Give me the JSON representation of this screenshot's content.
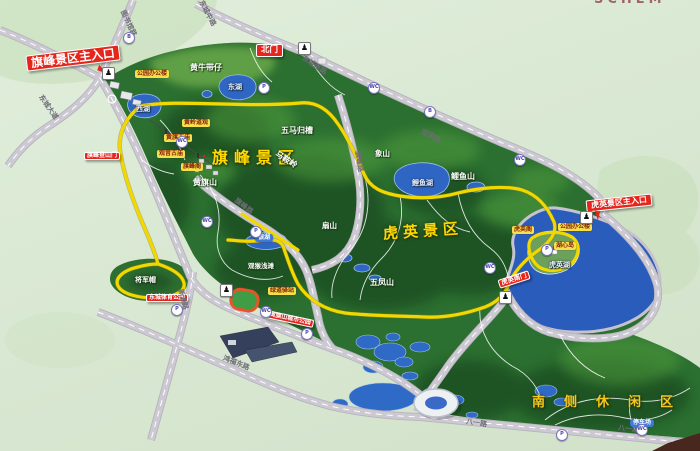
{
  "board": {
    "partial_top_text": "SCHEM"
  },
  "zones": [
    {
      "label": "旗峰景区"
    },
    {
      "label": "虎英景区"
    },
    {
      "label": "南侧休闲区"
    }
  ],
  "entrance_signs": [
    {
      "label": "旗峰景区主入口"
    },
    {
      "label": "北门"
    },
    {
      "label": "旗峰登山门"
    },
    {
      "label": "虎英景区主入口"
    },
    {
      "label": "虎英南门"
    },
    {
      "label": "东城体育公园"
    },
    {
      "label": "黄旗山城市公园"
    }
  ],
  "road_labels": [
    {
      "label": "图书馆路"
    },
    {
      "label": "东城大道"
    },
    {
      "label": "东城中路"
    },
    {
      "label": "东城南路"
    },
    {
      "label": "迎宾路"
    },
    {
      "label": "旗峰路"
    },
    {
      "label": "旗峰路"
    },
    {
      "label": "新源路"
    },
    {
      "label": "鸿福东路"
    },
    {
      "label": "八一路"
    },
    {
      "label": "八一路"
    }
  ],
  "mountain_labels": [
    {
      "label": "黄牛带仔"
    },
    {
      "label": "五马归槽"
    },
    {
      "label": "马鞍岭"
    },
    {
      "label": "黄旗山"
    },
    {
      "label": "将军帽"
    },
    {
      "label": "象山"
    },
    {
      "label": "鲤鱼山"
    },
    {
      "label": "扇山"
    },
    {
      "label": "五凤山"
    },
    {
      "label": "观猴浅滩"
    }
  ],
  "lake_labels": [
    {
      "label": "东湖"
    },
    {
      "label": "西湖"
    },
    {
      "label": "鲤鱼湖"
    },
    {
      "label": "虎英湖"
    }
  ],
  "blue_tags": [
    {
      "label": "银湖"
    },
    {
      "label": "停车场"
    }
  ],
  "poi_labels": [
    {
      "label": "公园办公楼"
    },
    {
      "label": "黄岭道观"
    },
    {
      "label": "黄旗古庙"
    },
    {
      "label": "观音古庙"
    },
    {
      "label": "旗峰阁"
    },
    {
      "label": "虎英阁"
    },
    {
      "label": "公园办公楼"
    },
    {
      "label": "湖心岛"
    },
    {
      "label": "绿道驿站"
    }
  ],
  "badges": [
    {
      "glyph": "B"
    },
    {
      "glyph": "WC"
    },
    {
      "glyph": "B"
    },
    {
      "glyph": "WC"
    },
    {
      "glyph": "P"
    },
    {
      "glyph": "WC"
    },
    {
      "glyph": "P"
    },
    {
      "glyph": "WC"
    },
    {
      "glyph": "WC"
    },
    {
      "glyph": "P"
    },
    {
      "glyph": "P"
    },
    {
      "glyph": "WC"
    },
    {
      "glyph": "P"
    },
    {
      "glyph": "WC"
    },
    {
      "glyph": "P"
    }
  ],
  "icons": {
    "gate_walker": "♟"
  },
  "colors": {
    "sign_red": "#e4261c",
    "route_yellow": "#f1d800",
    "water_blue": "#2f66c4",
    "park_green": "#2c7031",
    "board_bg": "#d9e7d3"
  }
}
